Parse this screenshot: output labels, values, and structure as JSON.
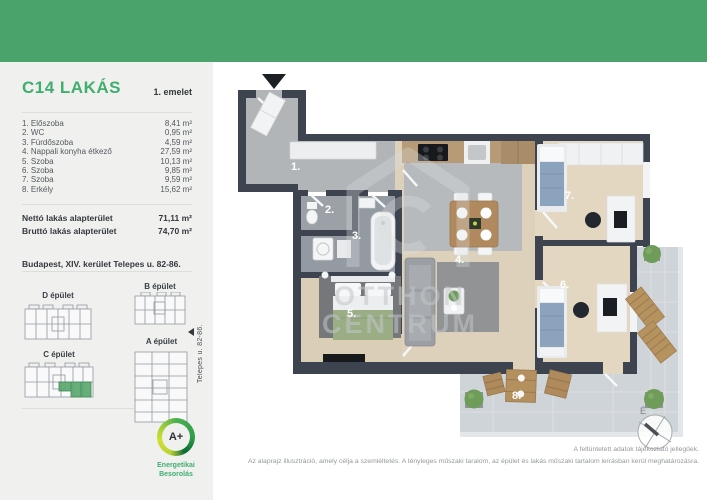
{
  "colors": {
    "header_green": "#4aa36b",
    "accent_green": "#3fae6e",
    "wall": "#3e4350",
    "highlight_unit": "#57a56c"
  },
  "sidebar": {
    "title": "C14 LAKÁS",
    "floor": "1. emelet",
    "rooms": [
      {
        "name": "1. Előszoba",
        "area": "8,41 m²"
      },
      {
        "name": "2. WC",
        "area": "0,95 m²"
      },
      {
        "name": "3. Fürdőszoba",
        "area": "4,59 m²"
      },
      {
        "name": "4. Nappali konyha étkező",
        "area": "27,59 m²"
      },
      {
        "name": "5. Szoba",
        "area": "10,13 m²"
      },
      {
        "name": "6. Szoba",
        "area": "9,85 m²"
      },
      {
        "name": "7. Szoba",
        "area": "9,59 m²"
      },
      {
        "name": "8. Erkély",
        "area": "15,62 m²"
      }
    ],
    "totals": [
      {
        "name": "Nettó lakás alapterület",
        "area": "71,11 m²"
      },
      {
        "name": "Bruttó lakás alapterület",
        "area": "74,70 m²"
      }
    ],
    "address": "Budapest, XIV. kerület Telepes u. 82-86.",
    "buildings": {
      "d": "D épület",
      "b": "B épület",
      "c": "C épület",
      "a": "A épület"
    },
    "street": "Telepes u. 82-86.",
    "energy": {
      "rating": "A+",
      "line1": "Energetikai",
      "line2": "Besorolás"
    }
  },
  "plan": {
    "labels": [
      "1.",
      "2.",
      "3.",
      "4.",
      "5.",
      "6.",
      "7.",
      "8."
    ],
    "compass": "É",
    "watermark1": "OTTHON",
    "watermark2": "CENTRUM"
  },
  "footer": {
    "line1": "A feltüntetett adatok tájékoztató jellegűek.",
    "line2": "Az alaprajz illusztráció, amely célja a szemléltetés. A tényleges műszaki taralom, az épület és lakás műszaki tartalom leírásban kerül meghatározásra."
  }
}
